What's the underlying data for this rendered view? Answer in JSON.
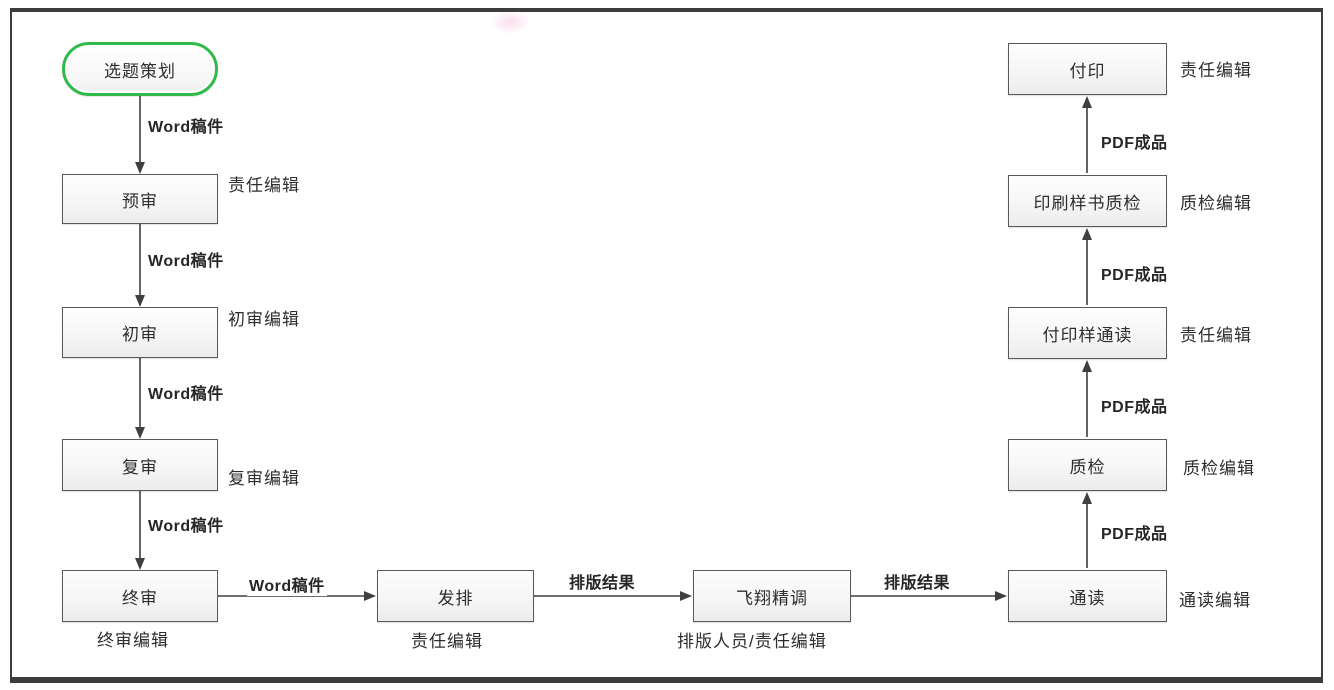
{
  "diagram": {
    "type": "flowchart",
    "subject": "book publishing workflow",
    "colors": {
      "start_node_border": "#2fba49",
      "process_border": "#595959",
      "process_fill": "#f4f4f4",
      "frame": "#3d3d3d",
      "arrow": "#3f3f3f",
      "text": "#2e2e2e"
    },
    "nodes": [
      {
        "id": "start",
        "shape": "stadium",
        "label": "选题策划",
        "role": ""
      },
      {
        "id": "yushen",
        "shape": "rect",
        "label": "预审",
        "role": "责任编辑"
      },
      {
        "id": "chushen",
        "shape": "rect",
        "label": "初审",
        "role": "初审编辑"
      },
      {
        "id": "fushen",
        "shape": "rect",
        "label": "复审",
        "role": "复审编辑"
      },
      {
        "id": "zhongshen",
        "shape": "rect",
        "label": "终审",
        "role": "终审编辑"
      },
      {
        "id": "fapai",
        "shape": "rect",
        "label": "发排",
        "role": "责任编辑"
      },
      {
        "id": "feixiang-jingtiao",
        "shape": "rect",
        "label": "飞翔精调",
        "role": "排版人员/责任编辑"
      },
      {
        "id": "tongdu",
        "shape": "rect",
        "label": "通读",
        "role": "通读编辑"
      },
      {
        "id": "zhijian",
        "shape": "rect",
        "label": "质检",
        "role": "质检编辑"
      },
      {
        "id": "fuyinyang-tongdu",
        "shape": "rect",
        "label": "付印样通读",
        "role": "责任编辑"
      },
      {
        "id": "yinshua-zhijian",
        "shape": "rect",
        "label": "印刷样书质检",
        "role": "质检编辑"
      },
      {
        "id": "fuyin",
        "shape": "rect",
        "label": "付印",
        "role": "责任编辑"
      }
    ],
    "edges": [
      {
        "from": "start",
        "to": "yushen",
        "label": "Word稿件"
      },
      {
        "from": "yushen",
        "to": "chushen",
        "label": "Word稿件"
      },
      {
        "from": "chushen",
        "to": "fushen",
        "label": "Word稿件"
      },
      {
        "from": "fushen",
        "to": "zhongshen",
        "label": "Word稿件"
      },
      {
        "from": "zhongshen",
        "to": "fapai",
        "label": "Word稿件"
      },
      {
        "from": "fapai",
        "to": "feixiang-jingtiao",
        "label": "排版结果"
      },
      {
        "from": "feixiang-jingtiao",
        "to": "tongdu",
        "label": "排版结果"
      },
      {
        "from": "tongdu",
        "to": "zhijian",
        "label": "PDF成品"
      },
      {
        "from": "zhijian",
        "to": "fuyinyang-tongdu",
        "label": "PDF成品"
      },
      {
        "from": "fuyinyang-tongdu",
        "to": "yinshua-zhijian",
        "label": "PDF成品"
      },
      {
        "from": "yinshua-zhijian",
        "to": "fuyin",
        "label": "PDF成品"
      }
    ]
  }
}
